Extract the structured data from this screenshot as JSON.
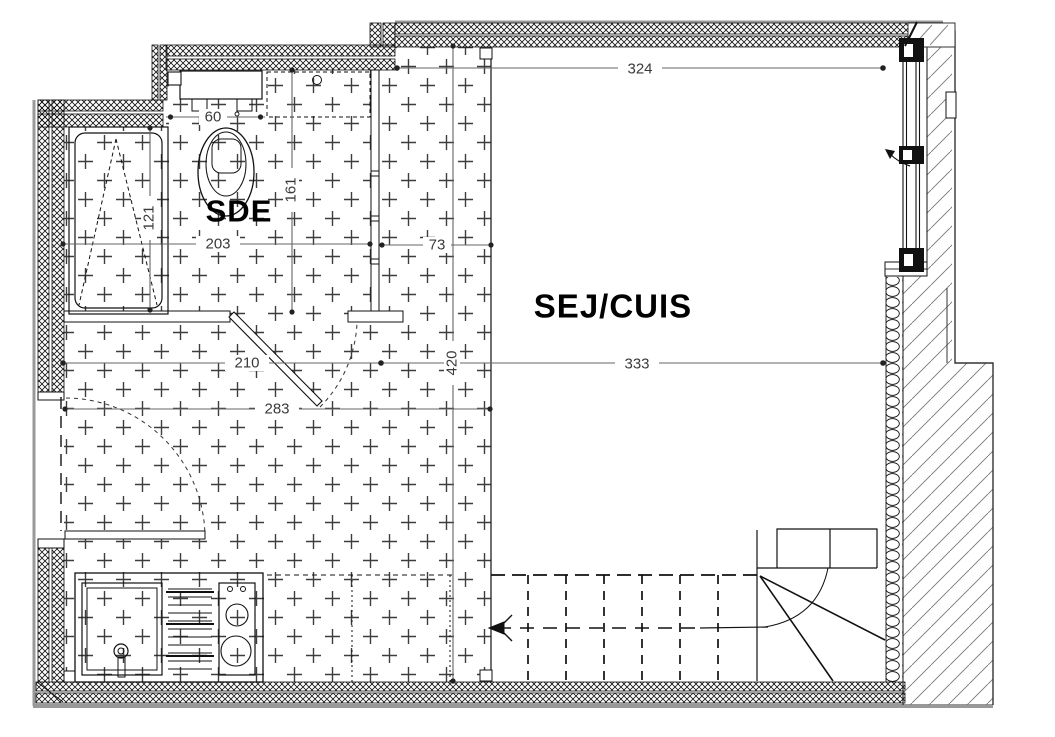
{
  "rooms": {
    "bathroom_label": "SDE",
    "living_kitchen_label": "SEJ/CUIS"
  },
  "dimensions": {
    "top_width": "324",
    "wc_width": "60",
    "bathroom_depth": "161",
    "shower_length": "121",
    "bathroom_width": "203",
    "hall_strip_width": "73",
    "lower_left_width": "210",
    "living_width": "333",
    "entry_width": "283",
    "hall_depth": "420"
  },
  "colors": {
    "ink": "#111111",
    "dimension_lines": "#666666",
    "hatch_gray": "#666666",
    "outer_edge_gray": "#999999",
    "tile_marks": "#3d3d3d"
  }
}
